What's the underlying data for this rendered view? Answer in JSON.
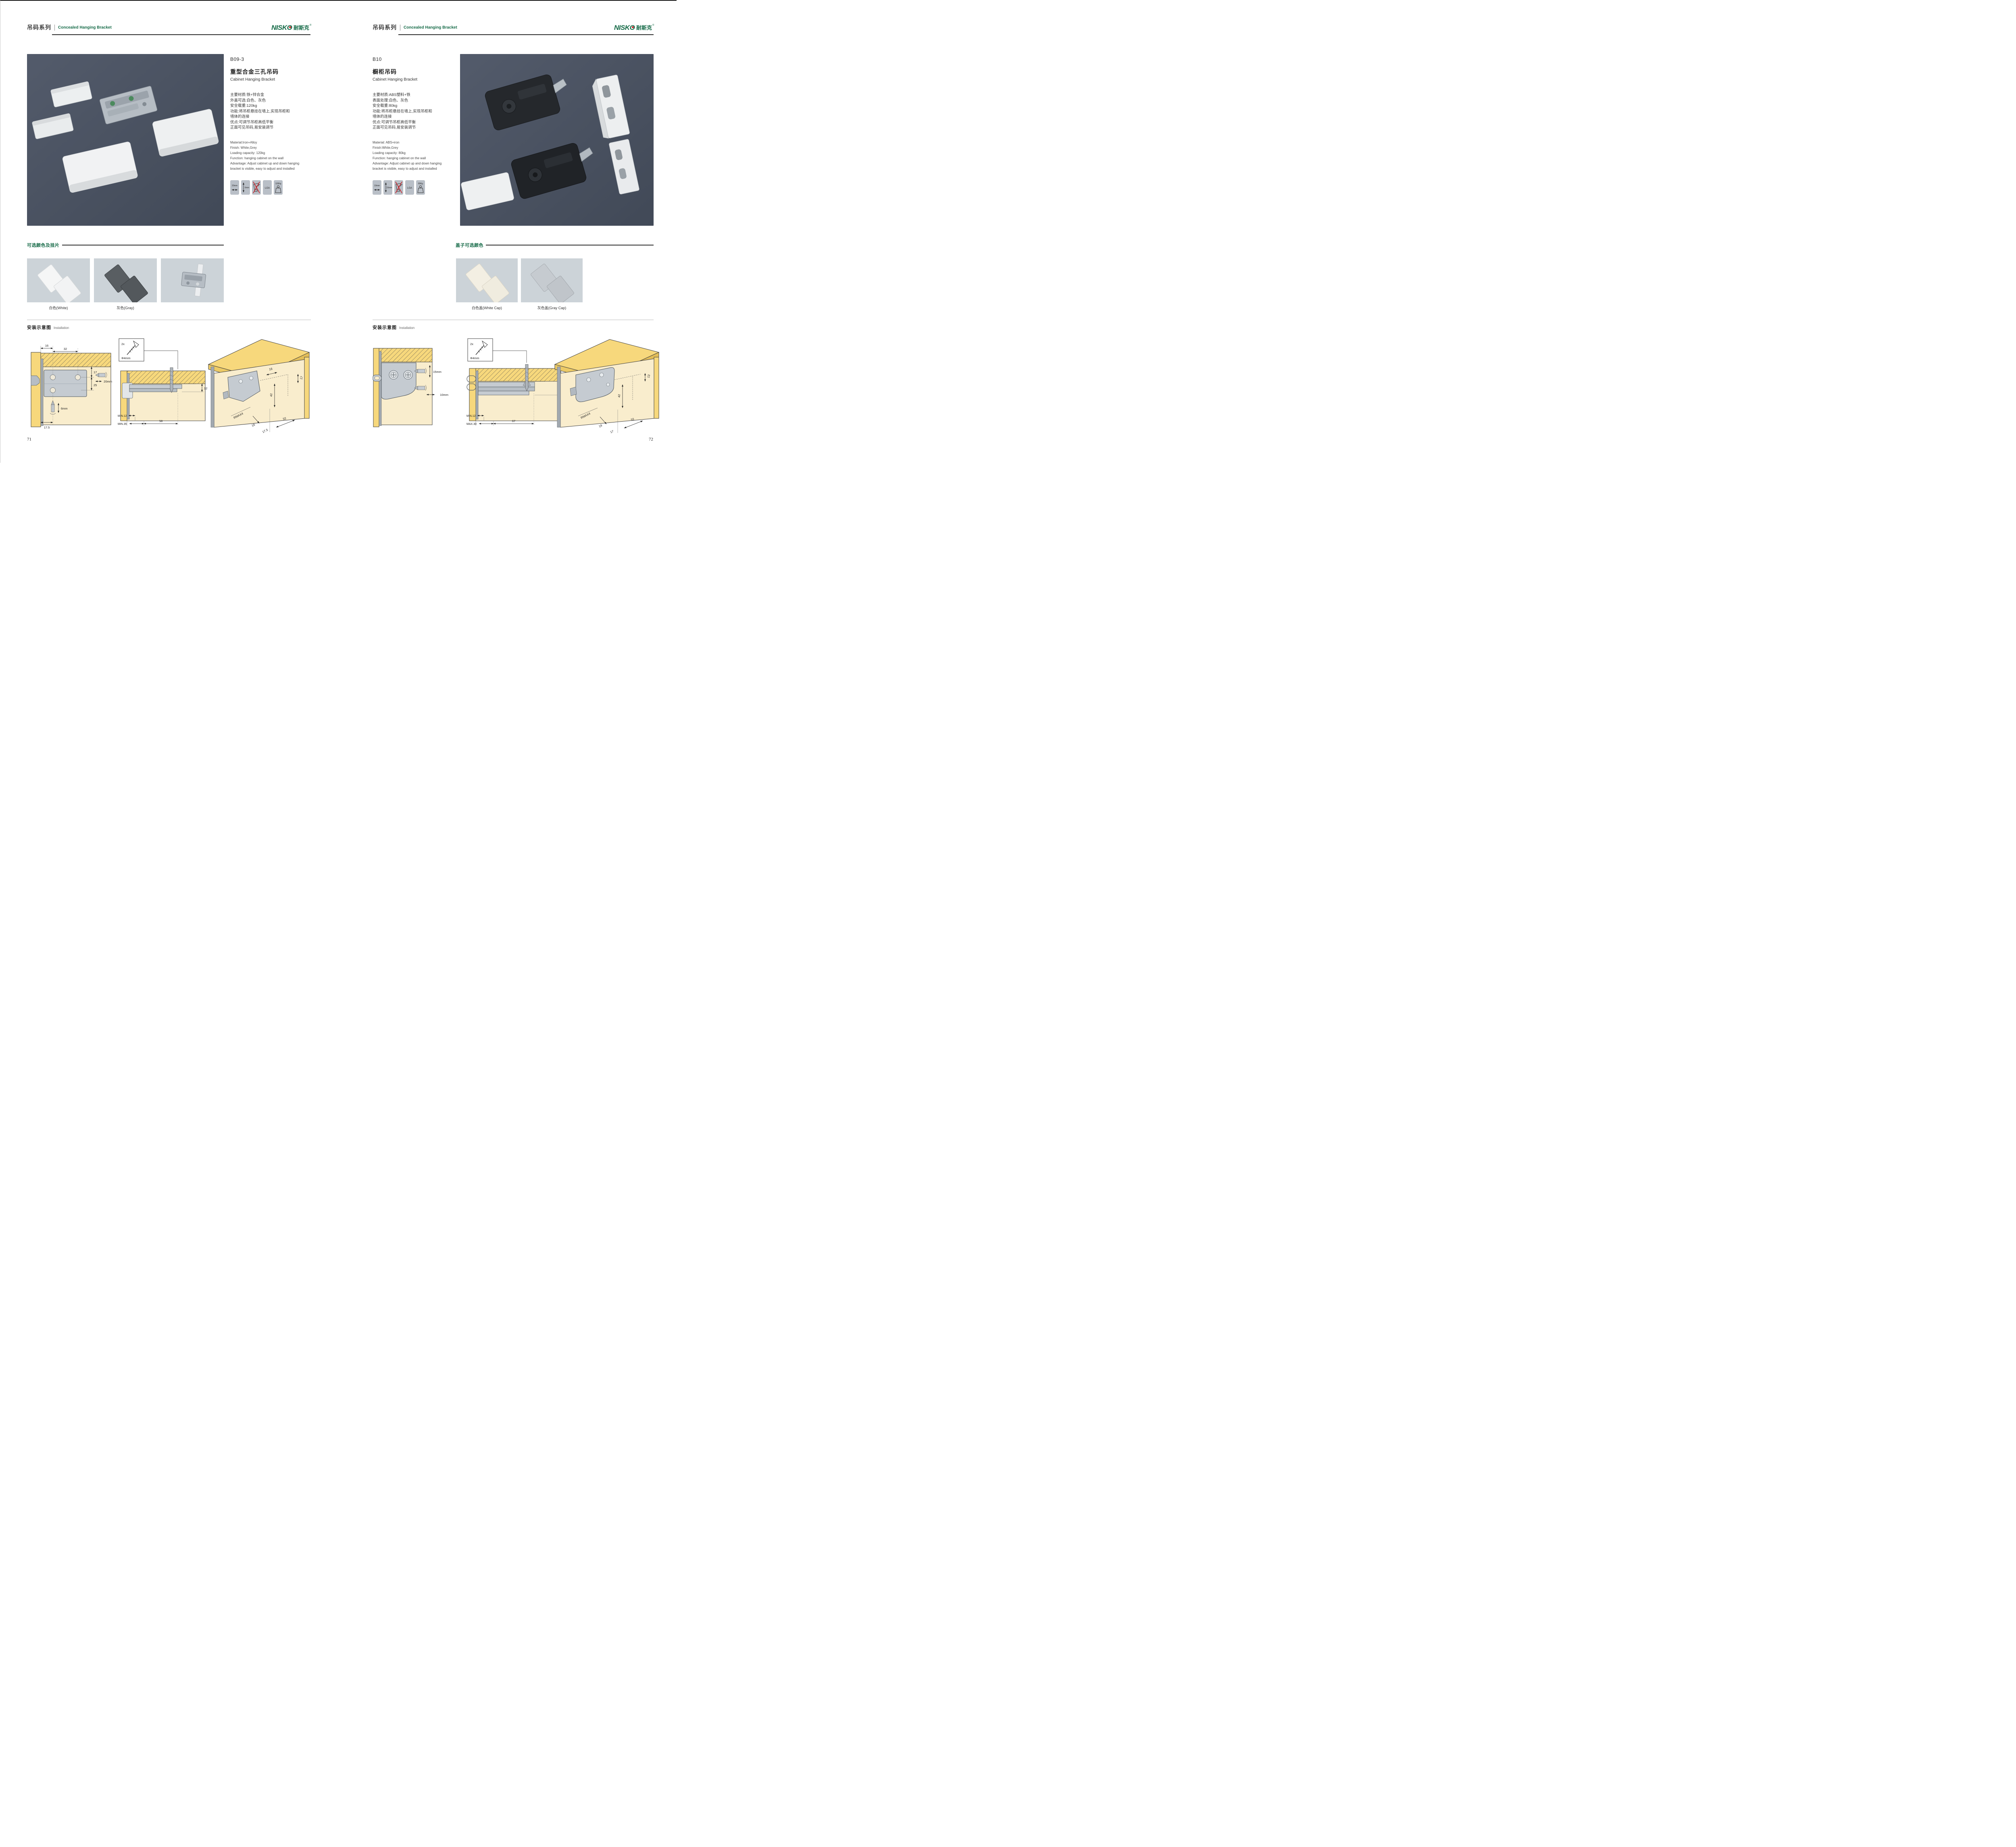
{
  "brand": {
    "en": "NISKO",
    "cn": "耐斯克",
    "reg": "®"
  },
  "colors": {
    "accent_green": "#156a47",
    "logo_red": "#d01f26",
    "photo_bg": "#4a5260",
    "badge_bg": "#b9bfc7",
    "swatch_card_bg": "#ccd3d8",
    "wood_yellow": "#f7d87c",
    "panel_cream": "#f9edcd",
    "bracket_gray": "#c5cbd1",
    "no_drill_red": "#cc2229"
  },
  "left": {
    "page_number": "71",
    "header": {
      "series_cn": "吊码系列",
      "series_en": "Concealed Hanging Bracket"
    },
    "product": {
      "model": "B09-3",
      "name_cn": "重型合金三孔吊码",
      "name_en": "Cabinet Hanging Bracket",
      "specs_cn": [
        "主要材质:铁+锌合金",
        "外盖可选:白色、灰色",
        "安全载重:120kg",
        "功能:将吊柜悬挂在墙上,实现吊柜和",
        "墙体的连接",
        "优点:可调节吊柜高低平衡",
        "正面可见吊码,易安装调节"
      ],
      "specs_en": [
        "Material:Iron+Alloy",
        "Finish: White,Grey",
        "Loading capacity: 120kg",
        "Function: hanging cabinet on the wall",
        "Advantage: Adjust cabinet up and down hanging",
        "bracket is visible, easy to adjust and installed"
      ],
      "badges": [
        {
          "icon": "width-arrow-icon",
          "label": "20mm"
        },
        {
          "icon": "depth-arrow-icon",
          "label": "6mm"
        },
        {
          "icon": "no-power-drill-icon",
          "label": ""
        },
        {
          "icon": "lga-cert",
          "label": "LGA"
        },
        {
          "icon": "load-weight-icon",
          "label": "120Kg"
        }
      ]
    },
    "colors_section": {
      "title": "可选颜色及挂片",
      "swatches": [
        {
          "label": "白色(White)"
        },
        {
          "label": "灰色(Gray)"
        },
        {
          "label": ""
        }
      ]
    },
    "installation": {
      "title_cn": "安装示意图",
      "title_en": "Installation",
      "d1": {
        "dim_16": "16",
        "dim_32": "32",
        "dim_17": "17",
        "dim_25": "25",
        "drill_h": "20mm",
        "drill_v": "6mm",
        "dim_175": "17.5"
      },
      "d2": {
        "qty": "2x",
        "dia": "Φ4mm",
        "thick": "12",
        "min1": "MIN.12",
        "min2": "MIN.35",
        "span": "58"
      },
      "d3": {
        "t16": "16",
        "t17": "17",
        "t42": "42",
        "rmax": "RMAX4",
        "b16": "16",
        "b175": "17.5",
        "b32": "32"
      }
    }
  },
  "right": {
    "page_number": "72",
    "header": {
      "series_cn": "吊码系列",
      "series_en": "Concealed Hanging Bracket"
    },
    "product": {
      "model": "B10",
      "name_cn": "橱柜吊码",
      "name_en": "Cabinet Hanging Bracket",
      "specs_cn": [
        "主要材质:ABS塑料+铁",
        "表面处理:白色、灰色",
        "安全载重:80kg",
        "功能:将吊柜悬挂在墙上,实现吊柜和",
        "墙体的连接",
        "优点:可调节吊柜高低平衡",
        "正面可见吊码,易安装调节"
      ],
      "specs_en": [
        "Material: ABS+iron",
        "Finish:White,Grey",
        "Loading capacity: 80kg",
        "Function: hanging cabinet on the wall",
        "Advantage: Adjust cabinet up and down hanging",
        "bracket is visible, easy to adjust and installed"
      ],
      "badges": [
        {
          "icon": "width-arrow-icon",
          "label": "10mm"
        },
        {
          "icon": "depth-arrow-icon",
          "label": "15mm"
        },
        {
          "icon": "no-power-drill-icon",
          "label": ""
        },
        {
          "icon": "lga-cert",
          "label": "LGA"
        },
        {
          "icon": "load-weight-icon",
          "label": "80Kg"
        }
      ]
    },
    "colors_section": {
      "title": "盖子可选颜色",
      "swatches": [
        {
          "label": "白色盖(White Cap)"
        },
        {
          "label": "灰色盖(Gray Cap)"
        }
      ]
    },
    "installation": {
      "title_cn": "安装示意图",
      "title_en": "Installation",
      "d1": {
        "drill_v": "15mm",
        "drill_h": "10mm"
      },
      "d2": {
        "qty": "2x",
        "dia": "Φ4mm",
        "thick": "18",
        "min1": "MIN.12",
        "max1": "MAX.30",
        "span": "67"
      },
      "d3": {
        "t13": "13",
        "t42": "42",
        "rmax": "RMAX4",
        "b19": "19",
        "b17": "17",
        "b32": "32"
      }
    }
  }
}
